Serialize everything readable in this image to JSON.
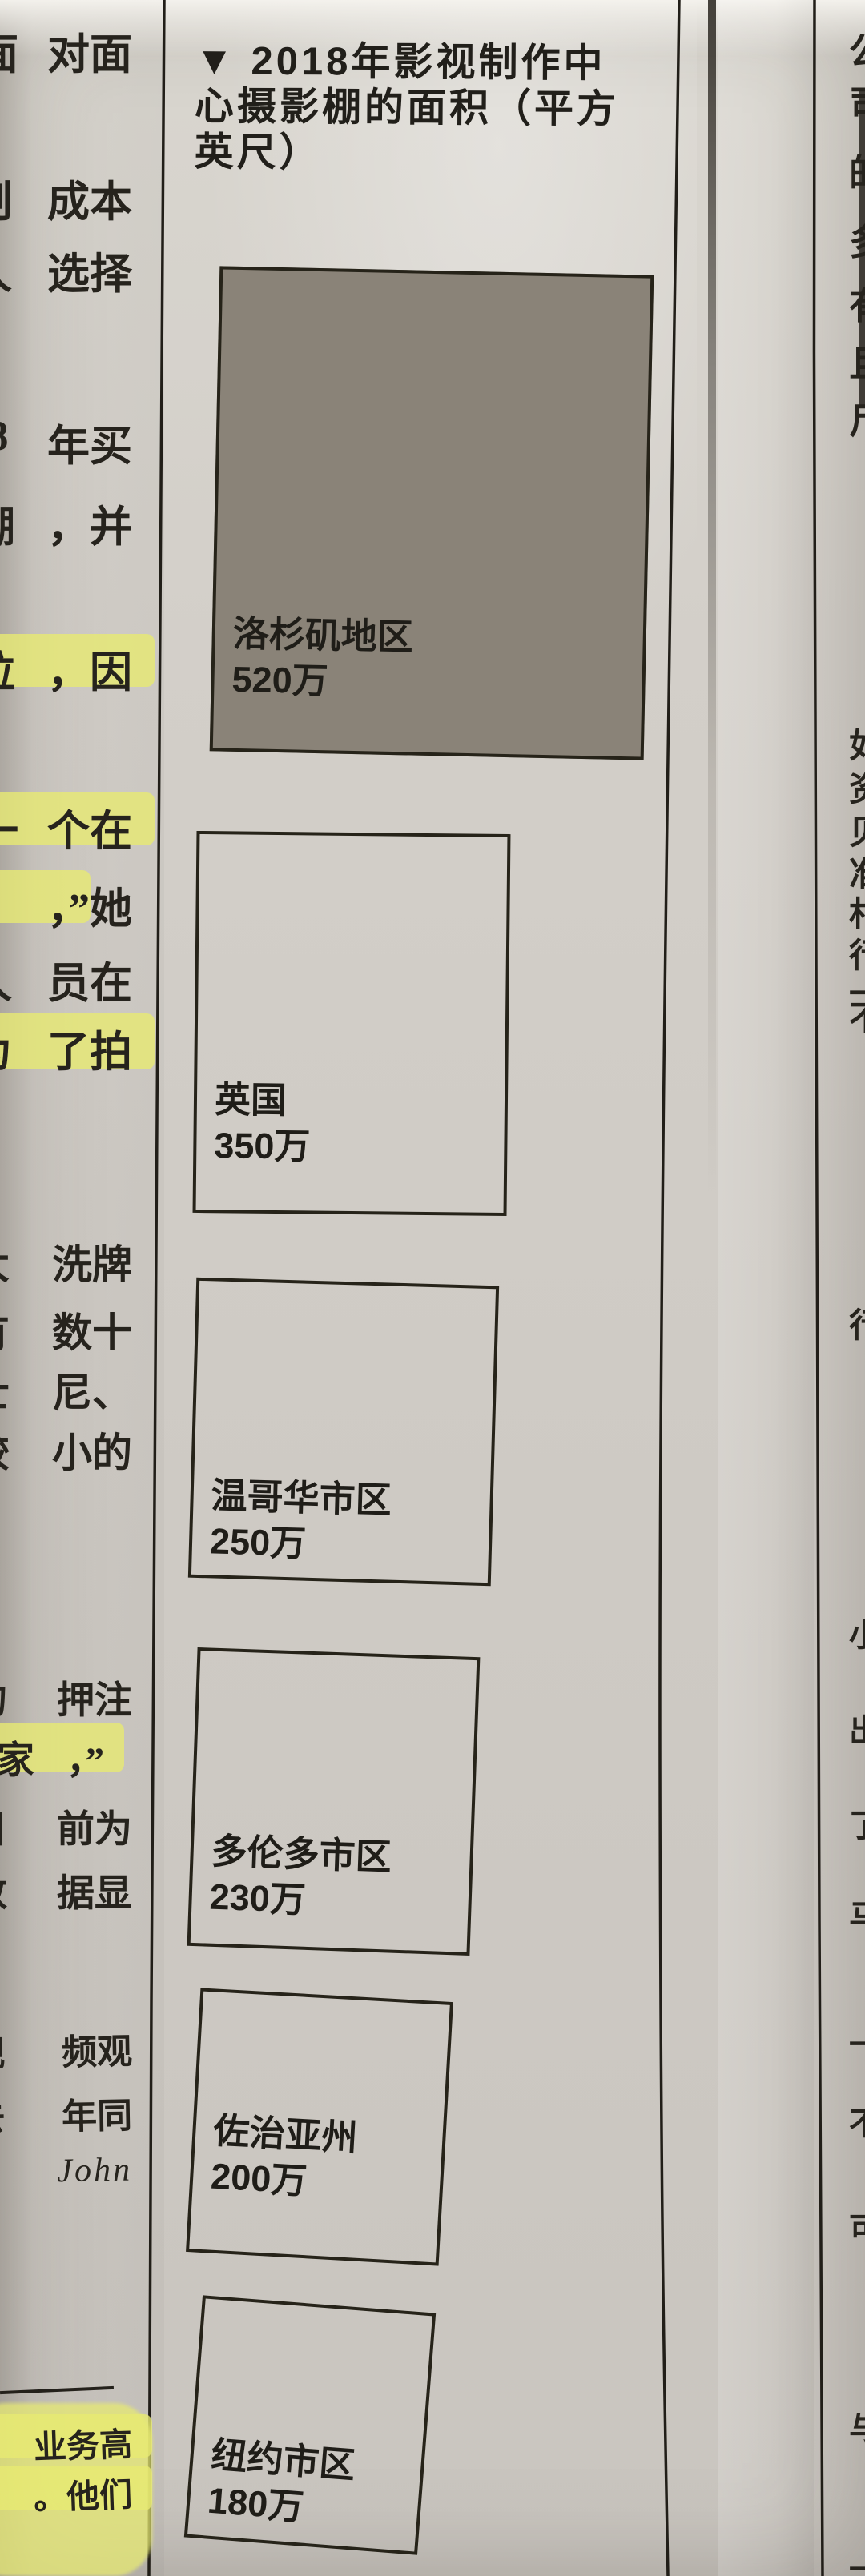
{
  "page": {
    "kind": "photographed newspaper clipping with area chart"
  },
  "colors": {
    "paper": "#d2cec8",
    "ink": "#26231d",
    "square_fill": "#8a8378",
    "highlighter": "#e7ea72",
    "rule": "#211e18"
  },
  "chart": {
    "marker": "▼",
    "title_lines": [
      "▼ 2018年影视制作中",
      "心摄影棚的面积（平方",
      "英尺）"
    ],
    "title_plain": "2018年影视制作中心摄影棚的面积（平方英尺）"
  },
  "chart_data": {
    "type": "bar",
    "variant": "proportional-squares",
    "title": "2018年影视制作中心摄影棚的面积（平方英尺）",
    "unit": "平方英尺",
    "categories": [
      "洛杉矶地区",
      "英国",
      "温哥华市区",
      "多伦多市区",
      "佐治亚州",
      "纽约市区"
    ],
    "values": [
      5200000,
      3500000,
      2500000,
      2300000,
      2000000,
      1800000
    ],
    "value_labels": [
      "520万",
      "350万",
      "250万",
      "230万",
      "200万",
      "180万"
    ],
    "highlighted_category": "洛杉矶地区",
    "legend": "面积与数值成比例的方块；首个方块灰色填充，其余仅描边"
  },
  "left_column": {
    "note": "被裁切的正文列，仅每行末2-3字可见，部分行有黄色荧光笔标记",
    "rows": [
      {
        "partial": "面",
        "text": "对面",
        "highlight": false
      },
      {
        "partial": "制",
        "text": "成本",
        "highlight": false
      },
      {
        "partial": "人",
        "text": "选择",
        "highlight": false
      },
      {
        "partial": "8",
        "text": "年买",
        "highlight": false
      },
      {
        "partial": "棚",
        "text": "，并",
        "highlight": false
      },
      {
        "partial": "拉",
        "text": "，因",
        "highlight": true
      },
      {
        "partial": "一",
        "text": "个在",
        "highlight": true
      },
      {
        "partial": "",
        "text": "，”她",
        "highlight": true
      },
      {
        "partial": "人",
        "text": "员在",
        "highlight": false
      },
      {
        "partial": "为",
        "text": "了拍",
        "highlight": true
      },
      {
        "partial": "大",
        "text": "洗牌",
        "highlight": false
      },
      {
        "partial": "有",
        "text": "数十",
        "highlight": false
      },
      {
        "partial": "士",
        "text": "尼、",
        "highlight": false
      },
      {
        "partial": "较",
        "text": "小的",
        "highlight": false
      },
      {
        "partial": "的",
        "text": "押注",
        "highlight": false
      },
      {
        "partial": "家",
        "text": "，”",
        "highlight": true
      },
      {
        "partial": "目",
        "text": "前为",
        "highlight": false
      },
      {
        "partial": "数",
        "text": "据显",
        "highlight": false
      },
      {
        "partial": "视",
        "text": "频观",
        "highlight": false
      },
      {
        "partial": "去",
        "text": "年同",
        "highlight": false
      },
      {
        "partial": "",
        "text": "John",
        "highlight": false
      },
      {
        "partial": "",
        "text": "业务高",
        "highlight": true
      },
      {
        "partial": "",
        "text": "。他们",
        "highlight": true
      }
    ]
  },
  "right_column": {
    "note": "右侧相邻版面列，仅字左侧残边可见（难以辨认）",
    "fragments": [
      {
        "char": "公"
      },
      {
        "char": "司"
      },
      {
        "char": "的"
      },
      {
        "char": "多"
      },
      {
        "char": "有"
      },
      {
        "char": "且"
      },
      {
        "char": "尸"
      },
      {
        "char": "如"
      },
      {
        "char": "资"
      },
      {
        "char": "贝"
      },
      {
        "char": "准"
      },
      {
        "char": "村"
      },
      {
        "char": "行"
      },
      {
        "char": "一"
      },
      {
        "char": "不"
      },
      {
        "char": "行"
      },
      {
        "char": "小"
      },
      {
        "char": "出"
      },
      {
        "char": "了"
      },
      {
        "char": "马"
      },
      {
        "char": "一"
      },
      {
        "char": "不"
      },
      {
        "char": "可"
      },
      {
        "char": "与"
      },
      {
        "char": "一"
      }
    ]
  }
}
